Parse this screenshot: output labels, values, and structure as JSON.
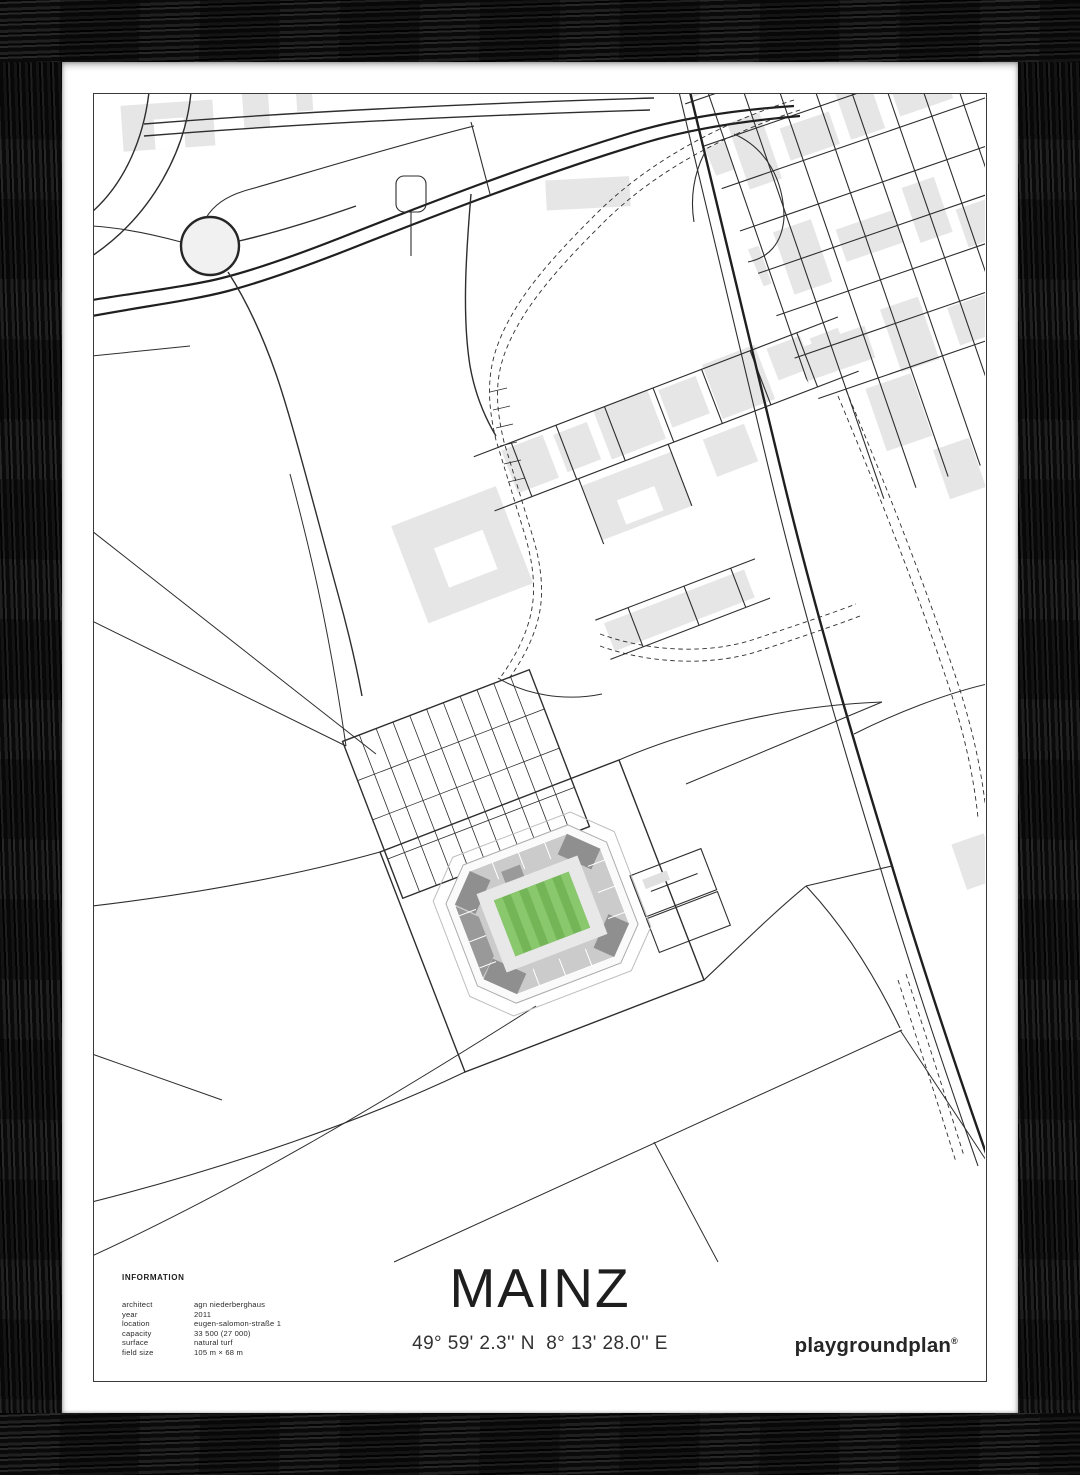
{
  "poster": {
    "title": "MAINZ",
    "coordinates": "49° 59' 2.3'' N  8° 13' 28.0'' E",
    "brand": "playgroundplan",
    "brand_mark": "®",
    "information": {
      "heading": "INFORMATION",
      "rows": [
        {
          "label": "architect",
          "value": "agn niederberghaus"
        },
        {
          "label": "year",
          "value": "2011"
        },
        {
          "label": "location",
          "value": "eugen-salomon-straße 1"
        },
        {
          "label": "capacity",
          "value": "33 500 (27 000)"
        },
        {
          "label": "surface",
          "value": "natural turf"
        },
        {
          "label": "field size",
          "value": "105 m × 68 m"
        }
      ]
    }
  },
  "map": {
    "features": [
      "roundabout",
      "dual-carriageway highway",
      "railway diagonal",
      "dashed tram path",
      "street-grid district with buildings",
      "campus building strip",
      "hatched parking lots",
      "stadium with striped green pitch",
      "open field boundaries"
    ]
  },
  "theme": {
    "road": "#2e2e2e",
    "road-dark": "#1f1f1f",
    "line-dark": "#3a3a3a",
    "building": "#e6e6e6",
    "pitch-green": "#74b657",
    "pitch-stripe": "#8ac86e",
    "stand-gray": "#cbcbcb",
    "stand-dark": "#8f8f8f",
    "frame-black": "#121212"
  }
}
